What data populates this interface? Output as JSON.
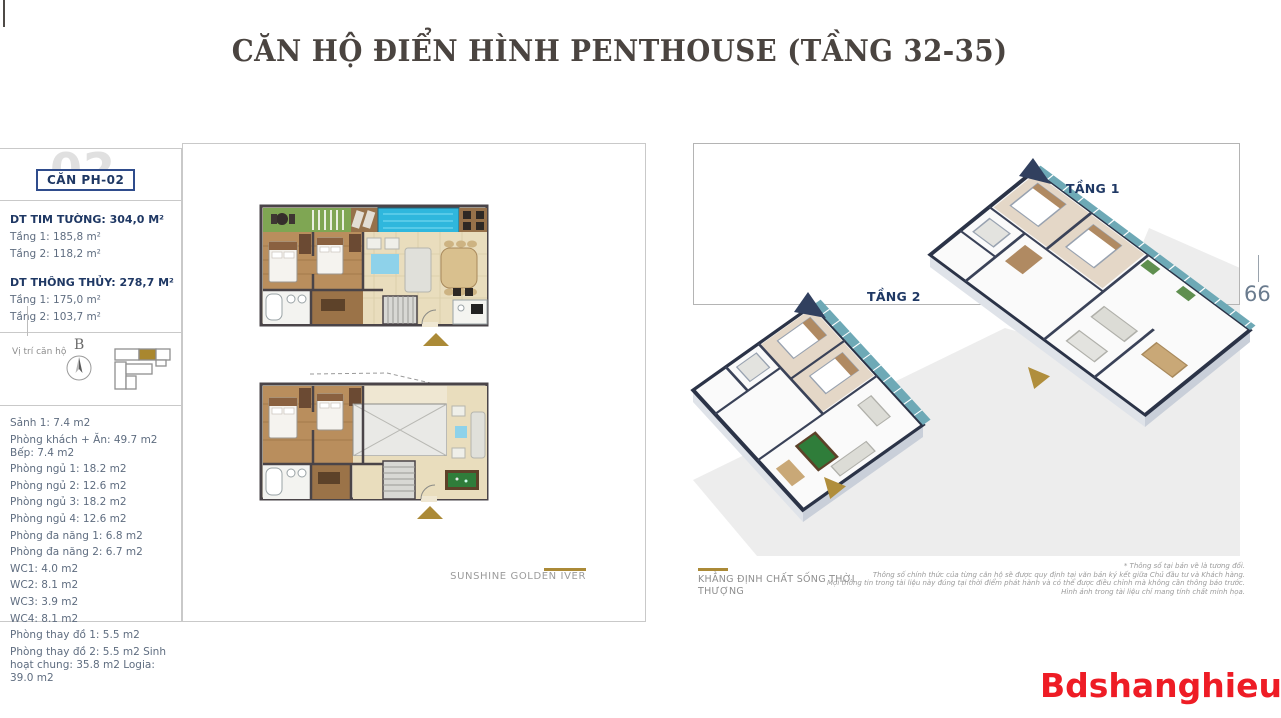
{
  "page": {
    "title": "CĂN HỘ ĐIỂN HÌNH PENTHOUSE (TẦNG 32-35)",
    "page_number": "66",
    "watermark": "Bdshanghieu.vn"
  },
  "sidebar": {
    "unit_bg_number": "02",
    "unit_label": "CĂN PH-02",
    "gross": {
      "heading": "DT TIM TƯỜNG: 304,0 M²",
      "floor1": "Tầng 1: 185,8 m²",
      "floor2": "Tầng 2: 118,2 m²"
    },
    "net": {
      "heading": "DT THÔNG THỦY: 278,7 M²",
      "floor1": "Tầng 1: 175,0 m²",
      "floor2": "Tầng 2: 103,7 m²"
    },
    "location": {
      "label": "Vị trí căn hộ",
      "compass_letter": "B"
    },
    "rooms": [
      "Sảnh 1: 7.4 m2",
      "Phòng khách + Ăn: 49.7 m2 Bếp: 7.4 m2",
      "Phòng ngủ 1: 18.2 m2",
      "Phòng ngủ 2: 12.6 m2",
      "Phòng ngủ 3: 18.2 m2",
      "Phòng ngủ 4: 12.6 m2",
      "Phòng đa năng 1: 6.8 m2",
      "Phòng đa năng 2: 6.7 m2",
      "WC1: 4.0 m2",
      "WC2: 8.1 m2",
      "WC3: 3.9 m2",
      "WC4: 8.1 m2",
      "Phòng thay đồ 1: 5.5 m2",
      "Phòng thay đồ 2: 5.5 m2  Sinh hoạt chung: 35.8 m2 Logia: 39.0 m2"
    ]
  },
  "plans": {
    "brand": "SUNSHINE GOLDEN IVER"
  },
  "views": {
    "floor1_label": "TẦNG 1",
    "floor2_label": "TẦNG 2",
    "tagline": "KHẲNG ĐỊNH CHẤT SỐNG THỜI THƯỢNG",
    "disclaimer": {
      "line1": "* Thông số tại bản vẽ là tương đối.",
      "line2": "Thông số chính thức của từng căn hộ sẽ được quy định tại văn bản ký kết giữa Chủ đầu tư và Khách hàng.",
      "line3": "Mọi thông tin trong tài liệu này đúng tại thời điểm phát hành và có thể được điều chỉnh mà không cần thông báo trước.",
      "line4": "Hình ảnh trong tài liệu chỉ mang tính chất minh họa."
    }
  },
  "colors": {
    "gold": "#AB8A37",
    "navy": "#1F3864",
    "red": "#EE1C25"
  }
}
